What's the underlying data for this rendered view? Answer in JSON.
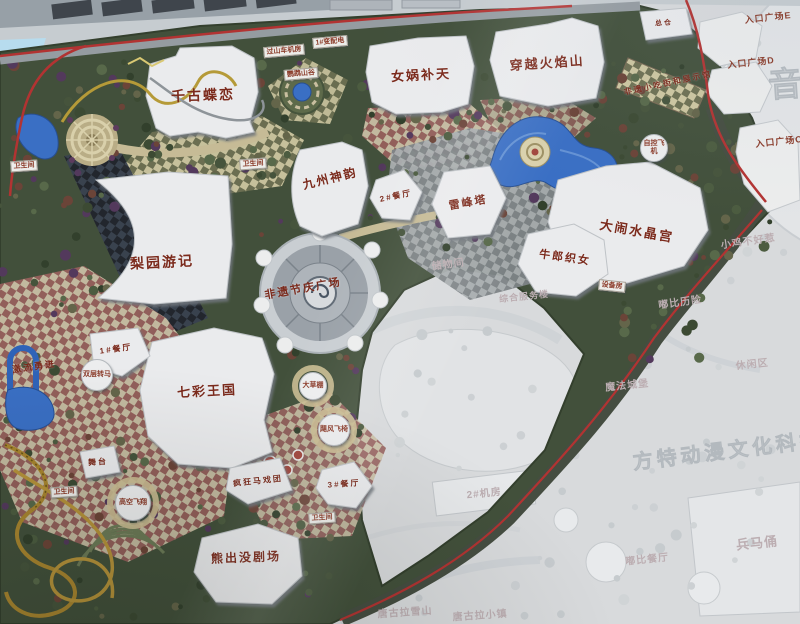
{
  "photo_subject": "theme park master plan map",
  "colors": {
    "label_red": "#7b2a1c",
    "boundary_red": "#b23332",
    "water_blue": "#3a6fc4",
    "park_green": "#42503b",
    "faded_area": "#d8dadc",
    "building_white": "#eaebed",
    "phase2_text": "#bcaeb2"
  },
  "labels": {
    "attractions": [
      {
        "id": "qiangu-dielian",
        "text": "千古蝶恋",
        "x": 203,
        "y": 95,
        "s": 14,
        "r": -2
      },
      {
        "id": "nuwa-butian",
        "text": "女娲补天",
        "x": 421,
        "y": 74,
        "s": 13,
        "r": -3
      },
      {
        "id": "chuanyue-huoyanshan",
        "text": "穿越火焰山",
        "x": 547,
        "y": 62,
        "s": 13,
        "r": -4
      },
      {
        "id": "jiuzhou-shenyun",
        "text": "九州神韵",
        "x": 330,
        "y": 178,
        "s": 12,
        "r": -14
      },
      {
        "id": "leifengta",
        "text": "雷峰塔",
        "x": 468,
        "y": 202,
        "s": 11,
        "r": -10
      },
      {
        "id": "danao-shuijinggong",
        "text": "大闹水晶宫",
        "x": 637,
        "y": 230,
        "s": 13,
        "r": 10
      },
      {
        "id": "niulang-zhinv",
        "text": "牛郎织女",
        "x": 565,
        "y": 257,
        "s": 11,
        "r": 8
      },
      {
        "id": "liyuan-youji",
        "text": "梨园游记",
        "x": 162,
        "y": 262,
        "s": 14,
        "r": -3
      },
      {
        "id": "feiyi-jieqing-plaza",
        "text": "非遗节庆广场",
        "x": 303,
        "y": 288,
        "s": 11,
        "r": -10
      },
      {
        "id": "qicai-wangguo",
        "text": "七彩王国",
        "x": 207,
        "y": 390,
        "s": 13,
        "r": -3
      },
      {
        "id": "xiongchumo-theater",
        "text": "熊出没剧场",
        "x": 246,
        "y": 557,
        "s": 12,
        "r": -2
      },
      {
        "id": "fengkuang-maxituan",
        "text": "疯狂马戏团",
        "x": 258,
        "y": 481,
        "s": 8,
        "r": -6
      },
      {
        "id": "canting-2",
        "text": "2#餐厅",
        "x": 396,
        "y": 196,
        "s": 8,
        "r": -12
      },
      {
        "id": "canting-1",
        "text": "1#餐厅",
        "x": 116,
        "y": 349,
        "s": 8,
        "r": -8
      },
      {
        "id": "canting-3",
        "text": "3#餐厅",
        "x": 344,
        "y": 484,
        "s": 8,
        "r": -4
      },
      {
        "id": "wutai",
        "text": "舞台",
        "x": 98,
        "y": 462,
        "s": 8,
        "r": -4
      },
      {
        "id": "zongcang",
        "text": "总仓",
        "x": 664,
        "y": 23,
        "s": 7,
        "r": -4
      },
      {
        "id": "feiyi-xiaochi-street",
        "text": "非遗小吃街和展示馆",
        "x": 668,
        "y": 83,
        "s": 8,
        "r": -12
      },
      {
        "id": "jiliu-yongjin",
        "text": "激流勇进",
        "x": 34,
        "y": 366,
        "s": 9,
        "r": -8
      }
    ],
    "rides": [
      {
        "id": "shuangceng-zhuanma",
        "text": "双层转马",
        "x": 97,
        "y": 375,
        "rad": 14
      },
      {
        "id": "dacaopeng",
        "text": "大草棚",
        "x": 313,
        "y": 386,
        "rad": 12
      },
      {
        "id": "jufeng-feiyi",
        "text": "飓风飞椅",
        "x": 334,
        "y": 430,
        "rad": 14
      },
      {
        "id": "gaokong-feixiang",
        "text": "高空飞翔",
        "x": 133,
        "y": 503,
        "rad": 16
      },
      {
        "id": "zikong-feiji",
        "text": "自控飞机",
        "x": 654,
        "y": 148,
        "rad": 12
      }
    ],
    "chips": [
      {
        "id": "weishengjian-1",
        "text": "卫生间",
        "x": 24,
        "y": 166,
        "r": -4
      },
      {
        "id": "weishengjian-2",
        "text": "卫生间",
        "x": 253,
        "y": 164,
        "r": -4
      },
      {
        "id": "weishengjian-3",
        "text": "卫生间",
        "x": 64,
        "y": 492,
        "r": -4
      },
      {
        "id": "weishengjian-4",
        "text": "卫生间",
        "x": 322,
        "y": 518,
        "r": -4
      },
      {
        "id": "guoshanche-jifang",
        "text": "过山车机房",
        "x": 284,
        "y": 51,
        "r": -5
      },
      {
        "id": "bianpeidian-1",
        "text": "1#变配电",
        "x": 330,
        "y": 42,
        "r": -5
      },
      {
        "id": "yingwu-shangu",
        "text": "鹦鹉山谷",
        "x": 301,
        "y": 74,
        "r": -5
      },
      {
        "id": "shebeifang",
        "text": "设备房",
        "x": 612,
        "y": 286,
        "r": 6
      }
    ],
    "entrances": [
      {
        "id": "entrance-plaza-e",
        "text": "入口广场E",
        "x": 768,
        "y": 17,
        "r": -6
      },
      {
        "id": "entrance-plaza-d",
        "text": "入口广场D",
        "x": 751,
        "y": 62,
        "r": -6
      },
      {
        "id": "entrance-plaza-c",
        "text": "入口广场C",
        "x": 779,
        "y": 141,
        "r": -6
      }
    ],
    "phase2": [
      {
        "id": "chuwujian",
        "text": "储物间",
        "x": 448,
        "y": 263,
        "s": 10,
        "r": -8
      },
      {
        "id": "zonghe-fuwulou",
        "text": "综合服务楼",
        "x": 524,
        "y": 296,
        "s": 9,
        "r": -6
      },
      {
        "id": "dubi-lixian",
        "text": "嘟比历险",
        "x": 680,
        "y": 301,
        "s": 10,
        "r": -8
      },
      {
        "id": "xiaoji-buhaore",
        "text": "小鸡不好惹",
        "x": 748,
        "y": 240,
        "s": 10,
        "r": -8
      },
      {
        "id": "xiuxianqu",
        "text": "休闲区",
        "x": 752,
        "y": 363,
        "s": 10,
        "r": -6
      },
      {
        "id": "mofa-chengbao",
        "text": "魔法城堡",
        "x": 627,
        "y": 384,
        "s": 10,
        "r": -6
      },
      {
        "id": "jifang-2",
        "text": "2#机房",
        "x": 484,
        "y": 492,
        "s": 10,
        "r": -6
      },
      {
        "id": "dubi-canting",
        "text": "嘟比餐厅",
        "x": 647,
        "y": 558,
        "s": 10,
        "r": -6
      },
      {
        "id": "bingmayong",
        "text": "兵马俑",
        "x": 757,
        "y": 542,
        "s": 13,
        "r": -6
      },
      {
        "id": "tanggula-xueshan",
        "text": "唐古拉雪山",
        "x": 405,
        "y": 611,
        "s": 10,
        "r": -4
      },
      {
        "id": "tanggula-xiaozhen",
        "text": "唐古拉小镇",
        "x": 480,
        "y": 614,
        "s": 10,
        "r": -4
      }
    ],
    "watermarks": [
      {
        "id": "fangte-donman",
        "text": "方特动漫文化科技",
        "x": 728,
        "y": 449,
        "s": 20,
        "r": -7
      },
      {
        "id": "yinyue",
        "text": "音乐",
        "x": 806,
        "y": 80,
        "s": 34,
        "r": -4
      }
    ]
  }
}
